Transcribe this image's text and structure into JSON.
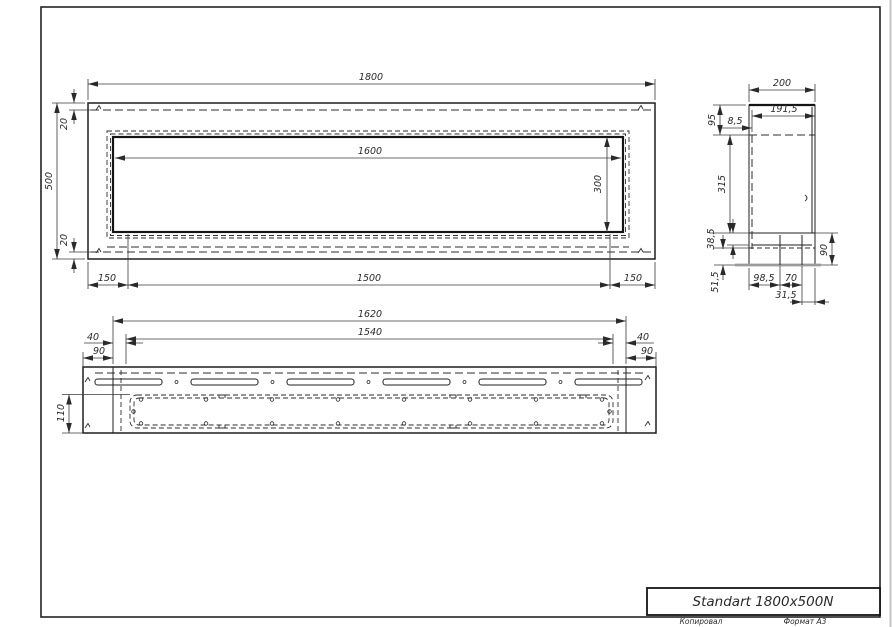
{
  "title_block": {
    "title": "Standart 1800x500N",
    "copied_label": "Копировал",
    "format_label": "Формат А3"
  },
  "front_view": {
    "dims": {
      "width": "1800",
      "height": "500",
      "top_inset": "20",
      "bottom_inset": "20",
      "opening_width": "1600",
      "opening_height": "300",
      "left_margin": "150",
      "center_span": "1500",
      "right_margin": "150"
    }
  },
  "side_view": {
    "dims": {
      "depth": "200",
      "inner_depth": "191,5",
      "top_section": "95",
      "wall_offset": "8,5",
      "middle_section": "315",
      "lower_lip": "38,5",
      "base_drop": "51,5",
      "base_length": "98,5",
      "hole_pitch": "70",
      "edge_offset": "31,5",
      "base_height": "90"
    }
  },
  "bottom_view": {
    "dims": {
      "mount_span": "1620",
      "tray_span": "1540",
      "left_gap": "40",
      "left_flange": "90",
      "right_gap": "40",
      "right_flange": "90",
      "tray_depth": "110"
    }
  },
  "colors": {
    "line": "#1f1f1f",
    "dimension": "#3a3a3a",
    "thick_gray": "#9a9a9a",
    "background": "#ffffff"
  }
}
